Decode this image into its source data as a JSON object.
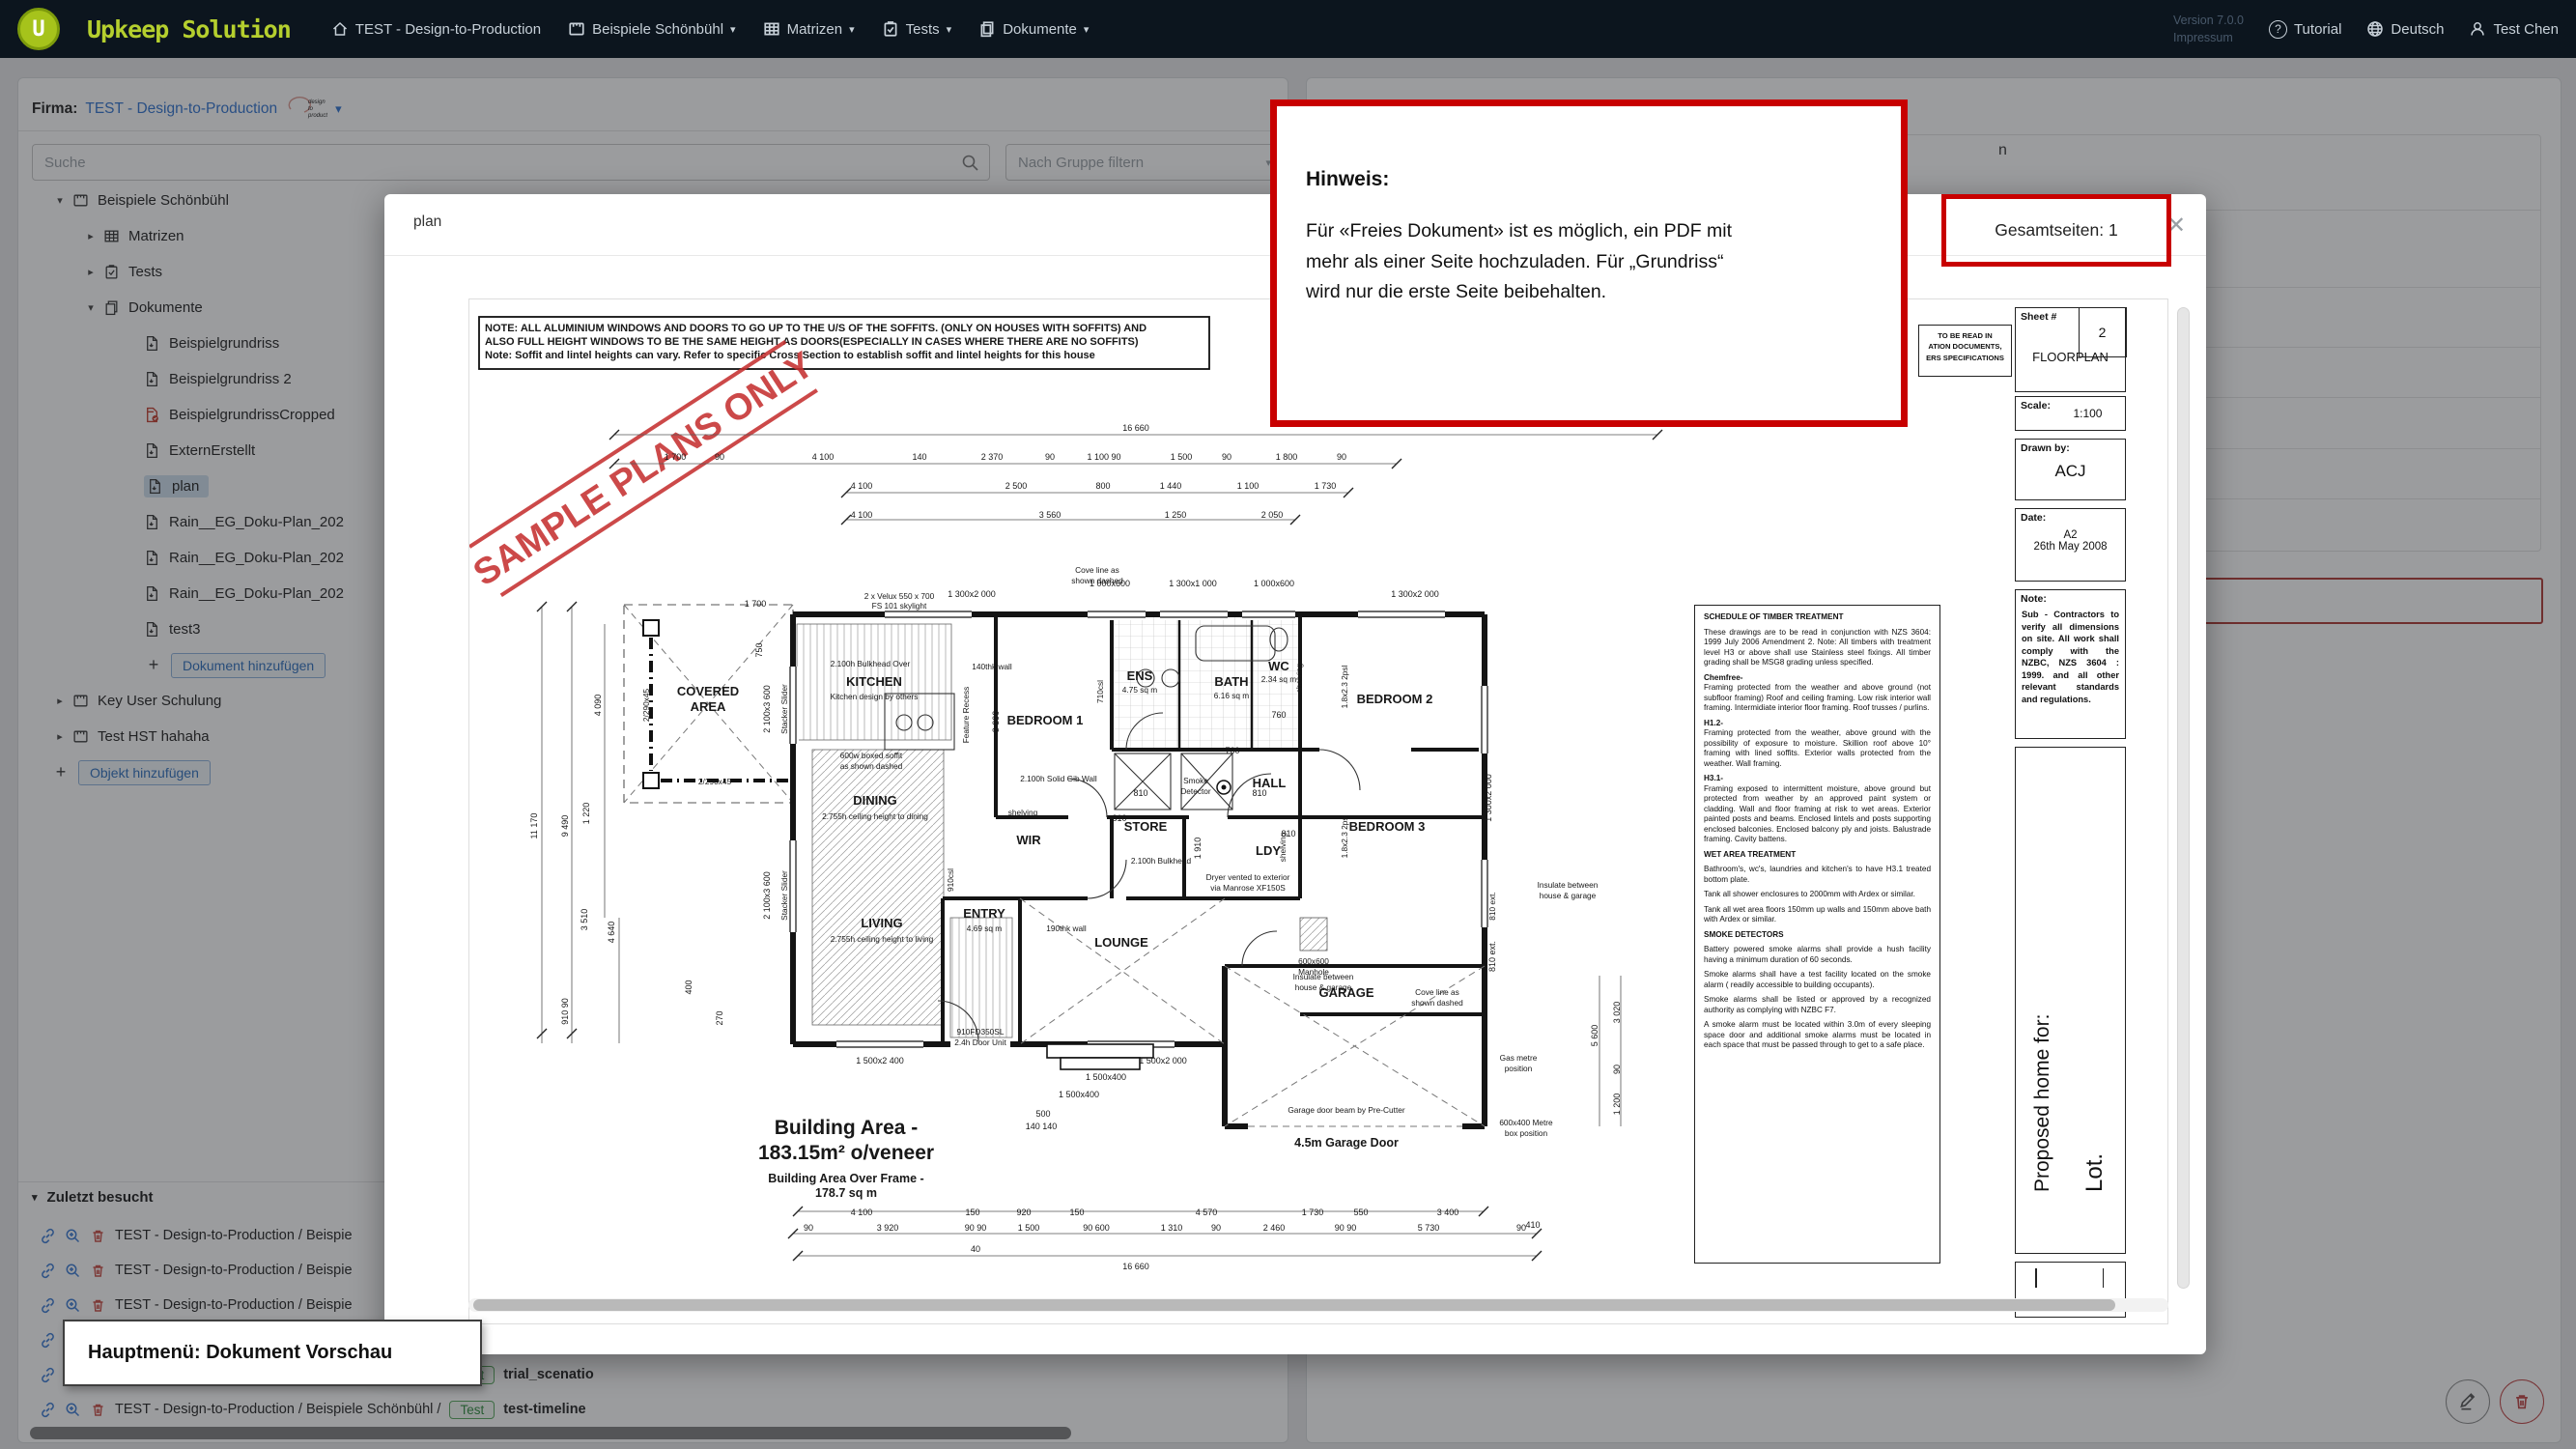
{
  "colors": {
    "nav_bg": "#0c151e",
    "accent_green": "#b5cf2e",
    "link_blue": "#3173d0",
    "annotation_red": "#c80000",
    "selected_row_bg": "#cfe0ee",
    "badge_green": "#2e8b3d",
    "delete_red": "#c84b44"
  },
  "icons": {
    "caret_down": "▾",
    "caret_right": "▸",
    "plus": "+",
    "close": "✕",
    "question_mark": "?",
    "search": "magnifier",
    "link": "chain-link",
    "zoom_in": "magnifier-plus",
    "delete": "trash",
    "edit": "pencil",
    "home": "house",
    "object": "frame-ruler",
    "grid": "table-grid",
    "tests": "clipboard-check",
    "documents": "pages",
    "globe": "globe",
    "user": "person",
    "pdf": "pdf-page"
  },
  "nav": {
    "logo_letter": "U",
    "brand_upkeep": "Upkeep",
    "brand_solution": "Solution",
    "items": [
      {
        "label": "TEST - Design-to-Production",
        "icon": "home"
      },
      {
        "label": "Beispiele Schönbühl",
        "icon": "object"
      },
      {
        "label": "Matrizen",
        "icon": "grid"
      },
      {
        "label": "Tests",
        "icon": "tests"
      },
      {
        "label": "Dokumente",
        "icon": "documents"
      }
    ],
    "version": "Version 7.0.0",
    "impressum": "Impressum",
    "tutorial": "Tutorial",
    "language": "Deutsch",
    "user": "Test Chen"
  },
  "sidebar": {
    "firma_label": "Firma:",
    "firma_value": "TEST - Design-to-Production",
    "firma_logo_lines": [
      "design",
      "to",
      "production"
    ],
    "search_placeholder": "Suche",
    "group_filter": "Nach Gruppe filtern",
    "tree": [
      {
        "label": "Beispiele Schönbühl"
      },
      {
        "label": "Matrizen"
      },
      {
        "label": "Tests"
      },
      {
        "label": "Dokumente"
      },
      {
        "label": "Beispielgrundriss"
      },
      {
        "label": "Beispielgrundriss 2"
      },
      {
        "label": "BeispielgrundrissCropped"
      },
      {
        "label": "ExternErstellt"
      },
      {
        "label": "plan"
      },
      {
        "label": "Rain__EG_Doku-Plan_202"
      },
      {
        "label": "Rain__EG_Doku-Plan_202"
      },
      {
        "label": "Rain__EG_Doku-Plan_202"
      },
      {
        "label": "test3"
      },
      {
        "label": "Dokument hinzufügen"
      },
      {
        "label": "Key User Schulung"
      },
      {
        "label": "Test HST hahaha"
      },
      {
        "label": "Objekt hinzufügen"
      }
    ],
    "recent_title": "Zuletzt besucht",
    "recent": [
      {
        "prefix": "TEST - Design-to-Production / Beispie"
      },
      {
        "prefix": "TEST - Design-to-Production / Beispie"
      },
      {
        "prefix": "TEST - Design-to-Production / Beispie"
      },
      {
        "prefix": "TEST - Design-to-Production / Beispie"
      },
      {
        "prefix": "TEST - Design-to-Production / Beispiele Schönbühl /",
        "badge": "Test",
        "name": "trial_scenatio"
      },
      {
        "prefix": "TEST - Design-to-Production / Beispiele Schönbühl /",
        "badge": "Test",
        "name": "test-timeline"
      }
    ]
  },
  "right_panel": {
    "visible_fragment": "n"
  },
  "modal": {
    "title": "plan",
    "total_pages_label": "Gesamtseiten: 1"
  },
  "annotations": {
    "hinweis_title": "Hinweis:",
    "hinweis_line1": "Für «Freies Dokument» ist es möglich, ein PDF mit",
    "hinweis_line2": "mehr als einer Seite hochzuladen. Für „Grundriss“",
    "hinweis_line3": "wird nur die erste Seite beibehalten.",
    "menu_label": "Hauptmenü: Dokument Vorschau"
  },
  "plan": {
    "note1": "NOTE: ALL ALUMINIUM WINDOWS AND DOORS TO GO UP TO THE U/S OF THE SOFFITS. (ONLY ON HOUSES WITH SOFFITS) AND",
    "note2": "ALSO FULL HEIGHT WINDOWS TO BE THE SAME HEIGHT AS DOORS(ESPECIALLY IN CASES WHERE THERE ARE NO SOFFITS)",
    "note3": "Note: Soffit and lintel heights can vary. Refer to specific Cross Section to establish soffit and lintel heights for this house",
    "stamp": "SAMPLE PLANS ONLY",
    "read_note": [
      "TO BE READ IN",
      "ATION DOCUMENTS,",
      "ERS SPECIFICATIONS"
    ],
    "labels": {
      "covered1": "COVERED",
      "covered2": "AREA",
      "kitchen": "KITCHEN",
      "kitchen_note": "Kitchen design by others",
      "bulkhead_over": "2.100h Bulkhead Over",
      "velux1": "2 x Velux 550 x 700",
      "velux2": "FS 101 skylight",
      "dining": "DINING",
      "ceil_dining": "2.755h ceiling height to dining",
      "living": "LIVING",
      "ceil_living": "2.755h ceiling height to living",
      "bed1": "BEDROOM 1",
      "ens": "ENS",
      "ens_area": "4.75 sq m",
      "bath": "BATH",
      "bath_area": "6.16 sq m",
      "wc": "WC",
      "wc_area": "2.34 sq m",
      "bed2": "BEDROOM 2",
      "hall": "HALL",
      "wir": "WIR",
      "store": "STORE",
      "ldy": "LDY",
      "bed3": "BEDROOM 3",
      "entry": "ENTRY",
      "entry_area": "4.69 sq m",
      "lounge": "LOUNGE",
      "garage": "GARAGE",
      "smoke1": "Smoke",
      "smoke2": "Detector",
      "gib": "2.100h Solid Gib Wall",
      "shelving": "shelving",
      "bulkhead": "2.100h Bulkhead",
      "dryer1": "Dryer vented to exterior",
      "dryer2": "via Manrose XF150S",
      "manhole1": "600x600",
      "manhole2": "Manhole",
      "insulate1": "Insulate between",
      "insulate2": "house & garage",
      "cove1": "Cove line as",
      "cove2": "shown dashed",
      "door_unit1": "910FD350SL",
      "door_unit2": "2.4h Door Unit",
      "wall140": "140thk wall",
      "wall190": "190thk wall",
      "csl710": "710csl",
      "csl910": "910csl",
      "feature": "Feature Recess",
      "stacker": "Stacker Slider",
      "beam290": "2/290x45",
      "soffit1": "600w boxed soffit",
      "soffit2": "as shown dashed",
      "psl": "1.8x2.3 2psl",
      "ext810": "810 ext.",
      "garage_beam": "Garage door beam by Pre-Cutter",
      "garage_door": "4.5m Garage Door",
      "gas1": "Gas metre",
      "gas2": "position",
      "meter1": "600x400 Metre",
      "meter2": "box position",
      "ba1": "Building Area -",
      "ba2": "183.15m² o/veneer",
      "ba3": "Building Area Over Frame -",
      "ba4": "178.7 sq m"
    },
    "dims": [
      "16 660",
      "1 700",
      "90",
      "4 100",
      "140",
      "2 370",
      "90",
      "1 100 90",
      "1 500",
      "90",
      "1 800",
      "90",
      "4 100",
      "2 500",
      "800",
      "1 440",
      "1 100",
      "1 730",
      "4 100",
      "3 560",
      "1 250",
      "2 050",
      "11 170",
      "9 490",
      "4 090",
      "1 220",
      "3 510",
      "4 640",
      "910 90",
      "400",
      "270",
      "1 700",
      "750",
      "2 100x3 600",
      "2 100x3 600",
      "1 300x2 000",
      "1 000x600",
      "1 300x1 000",
      "1 000x600",
      "1 300x2 000",
      "1 300x2 000",
      "810 ext.",
      "5 600",
      "3 020",
      "90",
      "1 200",
      "1 500x2 400",
      "1 500x2 000",
      "1 500x400",
      "1 500x400",
      "500",
      "140   140",
      "4 100",
      "150",
      "920",
      "150",
      "4 570",
      "1 730",
      "550",
      "3 400",
      "410",
      "90",
      "3 920",
      "90 90",
      "1 500",
      "90 600",
      "1 310",
      "90",
      "2 460",
      "90 90",
      "5 730",
      "90",
      "40",
      "16 660",
      "810",
      "810",
      "810",
      "810",
      "760",
      "760",
      "1 910",
      "3 390"
    ],
    "schedule": {
      "title": "SCHEDULE OF TIMBER TREATMENT",
      "paras": [
        "These drawings are to be read in conjunction with NZS 3604: 1999 July 2006 Amendment 2. Note: All timbers with treatment level H3 or above shall use Stainless steel fixings. All timber grading shall be MSG8 grading unless specified.",
        "Chemfree-",
        "Framing protected from the weather and above ground (not subfloor framing) Roof and ceiling framing. Low risk interior wall framing. Intermidiate interior floor framing. Roof trusses / purlins.",
        "H1.2-",
        "Framing protected from the weather, above ground with the possibility of exposure to moisture. Skillion roof above 10° framing with lined soffits. Exterior walls protected from the weather. Wall framing.",
        "H3.1-",
        "Framing exposed to intermittent moisture, above ground but protected from weather by an approved paint system or cladding. Wall and floor framing at risk to wet areas. Exterior painted posts and beams. Enclosed lintels and posts supporting enclosed balconies. Enclosed balcony ply and joists. Balustrade framing. Cavity battens.",
        "WET AREA TREATMENT",
        "Bathroom's, wc's, laundries and kitchen's to have H3.1 treated bottom plate.",
        "Tank all shower enclosures to 2000mm with Ardex or similar.",
        "Tank all wet area floors 150mm up walls and 150mm above bath with Ardex or similar.",
        "SMOKE DETECTORS",
        "Battery powered smoke alarms shall provide a hush facility having a minimum duration of 60 seconds.",
        "Smoke alarms shall have a test facility located on the smoke alarm ( readily accessible to building occupants).",
        "Smoke alarms shall be listed or approved by a recognized authority as complying with NZBC F7.",
        "A smoke alarm must be located within 3.0m of every sleeping space door and additional smoke alarms must be located in each space that must be passed through to get to a safe place."
      ]
    },
    "titleblock": {
      "sheet_label": "Sheet #",
      "sheet_no": "2",
      "type": "FLOORPLAN",
      "scale_label": "Scale:",
      "scale": "1:100",
      "drawn_label": "Drawn by:",
      "drawn": "ACJ",
      "date_label": "Date:",
      "date1": "A2",
      "date2": "26th May 2008",
      "note_label": "Note:",
      "note": "Sub - Contractors to verify all dimensions on site.  All work shall comply with the NZBC, NZS 3604 : 1999. and all other relevant standards and regulations.",
      "proposed": "Proposed home for:",
      "lot": "Lot."
    }
  }
}
